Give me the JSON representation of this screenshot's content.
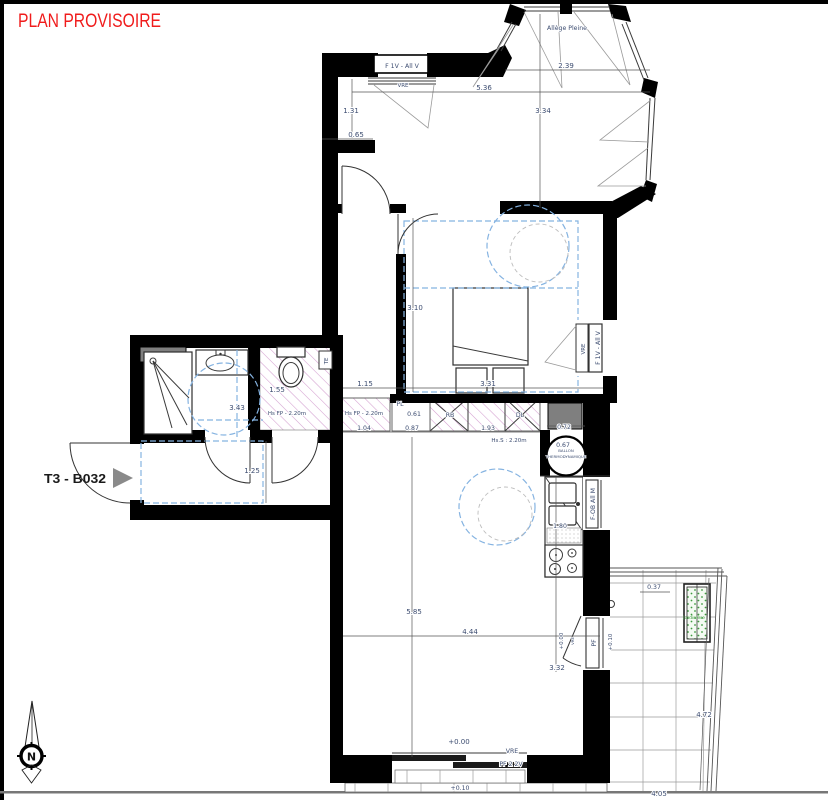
{
  "title": "PLAN PROVISOIRE",
  "unit_label": "T3 - B032",
  "compass": "N",
  "labels": {
    "window_top": "F 1V - All V",
    "window_bedroom": "F 1V - All V",
    "window_kitchen": "F-OB All M",
    "vre_top": "VRE",
    "vre_bedroom": "VRE",
    "vre_bottom": "VRE",
    "vre_door": "VRE",
    "allege": "Allège Pleine",
    "pf": "PF",
    "pf_bottom": "PF 2 2V",
    "te": "TE",
    "pl": "PL",
    "rb": "RB",
    "dl": "DL",
    "ballon1": "BALLON",
    "ballon2": "THERMODYNAMIQUE",
    "jardiniere": "Jardinière",
    "hs_fp_wc": "Hs FP - 2.20m",
    "hs_fp_entry": "Hs FP - 2.20m",
    "hs_s": "Hs.S : 2.20m"
  },
  "levels": {
    "zero": "+0.00",
    "zero_door": "+0.00",
    "plus10": "+0.10",
    "plus10_balcony": "+0.10"
  },
  "dims": {
    "hall_h": "1.31",
    "hall_w": "0.65",
    "top_w": "5.36",
    "bay_w": "2.39",
    "upper_h": "3.34",
    "bedroom_h": "3.10",
    "hall2_w": "1.15",
    "bedroom_w": "3.31",
    "bath_w": "3.43",
    "wc_h": "1.55",
    "entry_w": "1.25",
    "pl_w": "0.61",
    "pl_w2": "0.87",
    "corr_w": "1.04",
    "closet_w": "1.93",
    "heater_w": "0.72",
    "heater_d": "0.67",
    "kitchen_h": "1.80",
    "living_h": "5.85",
    "living_w": "4.44",
    "living_e": "3.32",
    "balcony_h": "4.72",
    "planter_w": "0.37",
    "balcony_w": "4.05"
  },
  "colors": {
    "title_red": "#f01c1c",
    "dim_blue": "#3c4c70",
    "hatch_pink": "#d49fd0",
    "dash_blue": "#85b3e1",
    "planter_green": "#3f9b3f",
    "duct_gray": "#7f7f7f",
    "wall_black": "#000000"
  }
}
